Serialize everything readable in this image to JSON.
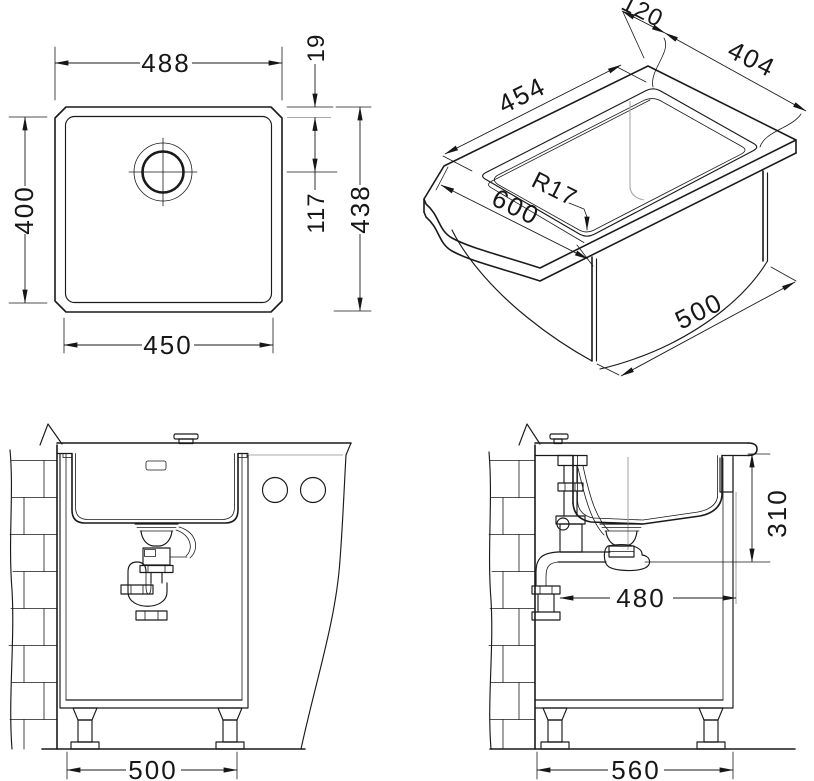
{
  "drawing": {
    "plan": {
      "outer_width": "488",
      "basin_width": "450",
      "basin_height": "400",
      "rim_width": "19",
      "drain_offset": "117",
      "outer_height": "438"
    },
    "iso": {
      "back_clearance": "120",
      "cutout_depth": "404",
      "cutout_width": "454",
      "corner_radius": "R17",
      "worktop_depth": "600",
      "cabinet_width": "500"
    },
    "front": {
      "cabinet_width": "500"
    },
    "side": {
      "height_to_waste": "310",
      "clearance": "480",
      "cabinet_depth": "560"
    }
  }
}
